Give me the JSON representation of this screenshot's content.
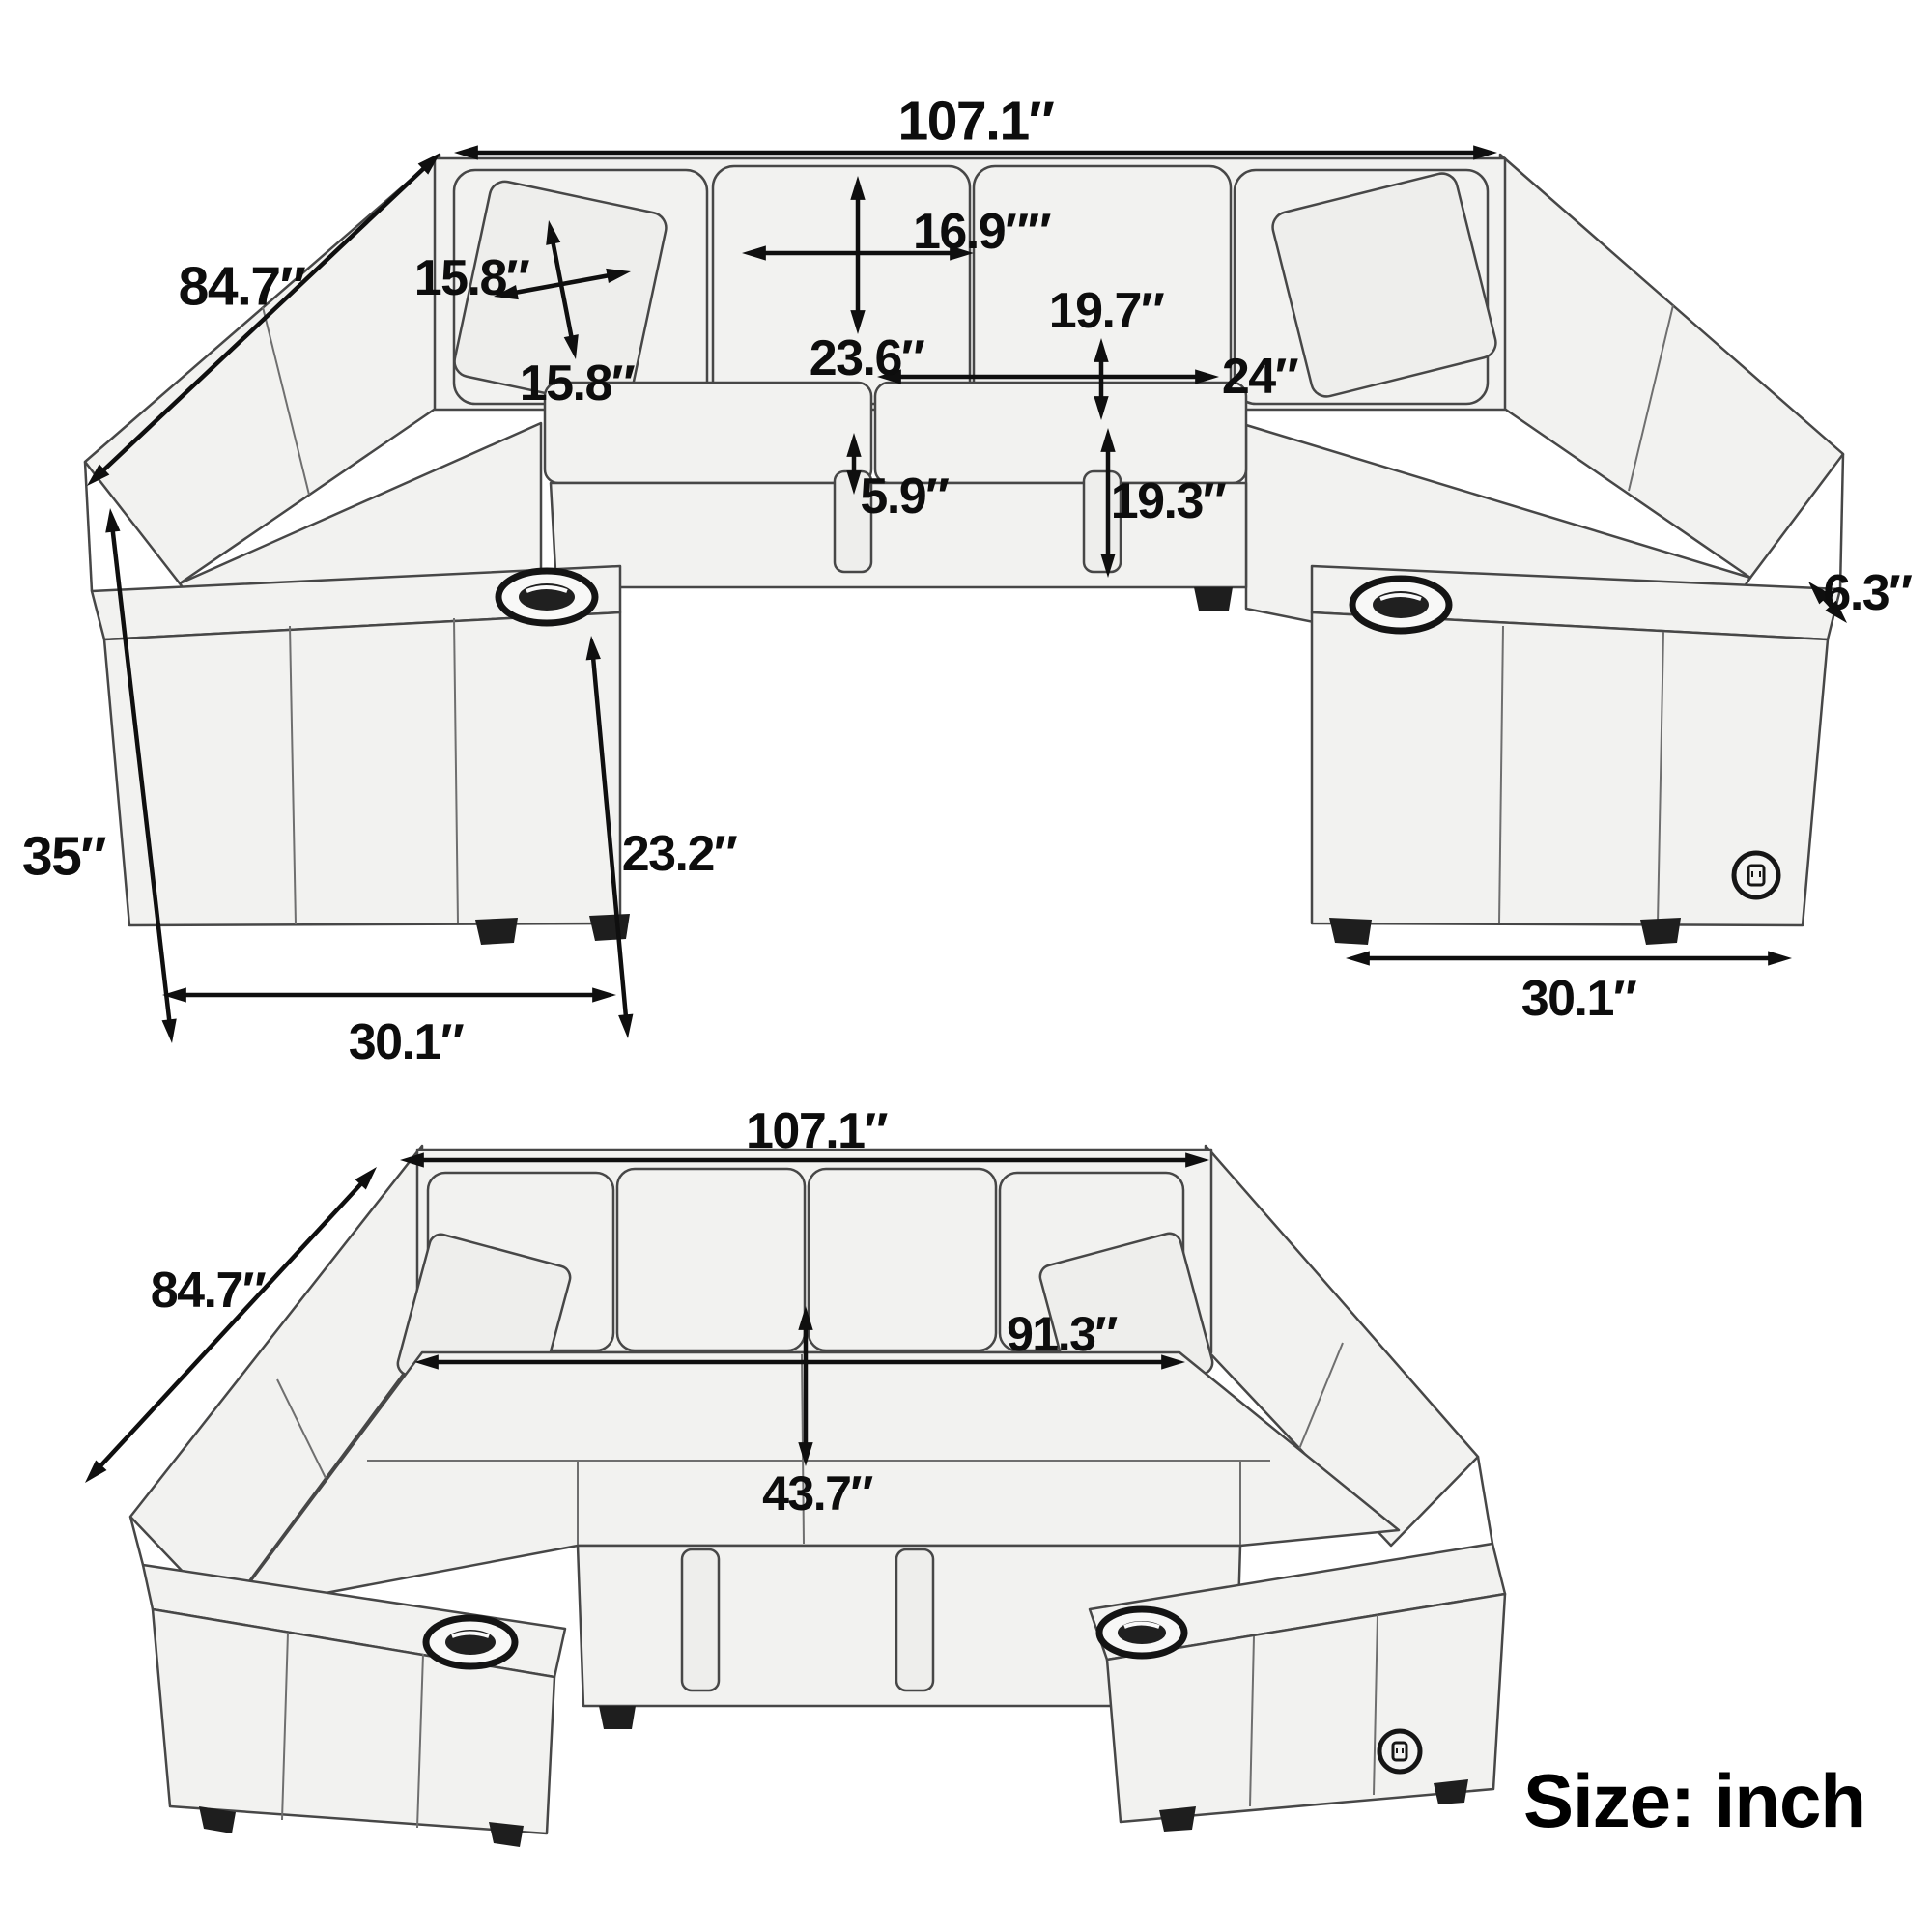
{
  "document": {
    "kind": "sofa-dimension-diagram",
    "background": "#ffffff"
  },
  "top_view": {
    "name": "sectional-sofa-front-perspective-view",
    "dims": {
      "overall_width": "107.1″",
      "depth": "84.7″",
      "pillow_width": "15.8″",
      "pillow_height": "15.8″",
      "back_cushion_width": "16.9″″",
      "back_cushion_height": "23.6″",
      "seat_depth": "19.7″",
      "seat_width": "24″",
      "seat_cushion_thickness": "5.9″",
      "base_height": "19.3″",
      "overall_height": "35″",
      "arm_inner_height": "23.2″",
      "left_arm_depth": "30.1″",
      "arm_top_width": "6.3″",
      "right_arm_depth": "30.1″"
    }
  },
  "bottom_view": {
    "name": "sectional-sofa-ottoman-out-view",
    "dims": {
      "overall_width": "107.1″",
      "depth": "84.7″",
      "interior_width": "91.3″",
      "interior_depth": "43.7″"
    }
  },
  "footer": {
    "unit_label": "Size: inch"
  },
  "icons": {
    "cup_holder": "cup-holder-icon",
    "usb_port": "usb-charging-port-icon"
  },
  "colors": {
    "dimension_line": "#0f0f0f",
    "fabric_fill": "#f2f2f0",
    "outline": "#474747",
    "feet": "#1e1e1e"
  }
}
